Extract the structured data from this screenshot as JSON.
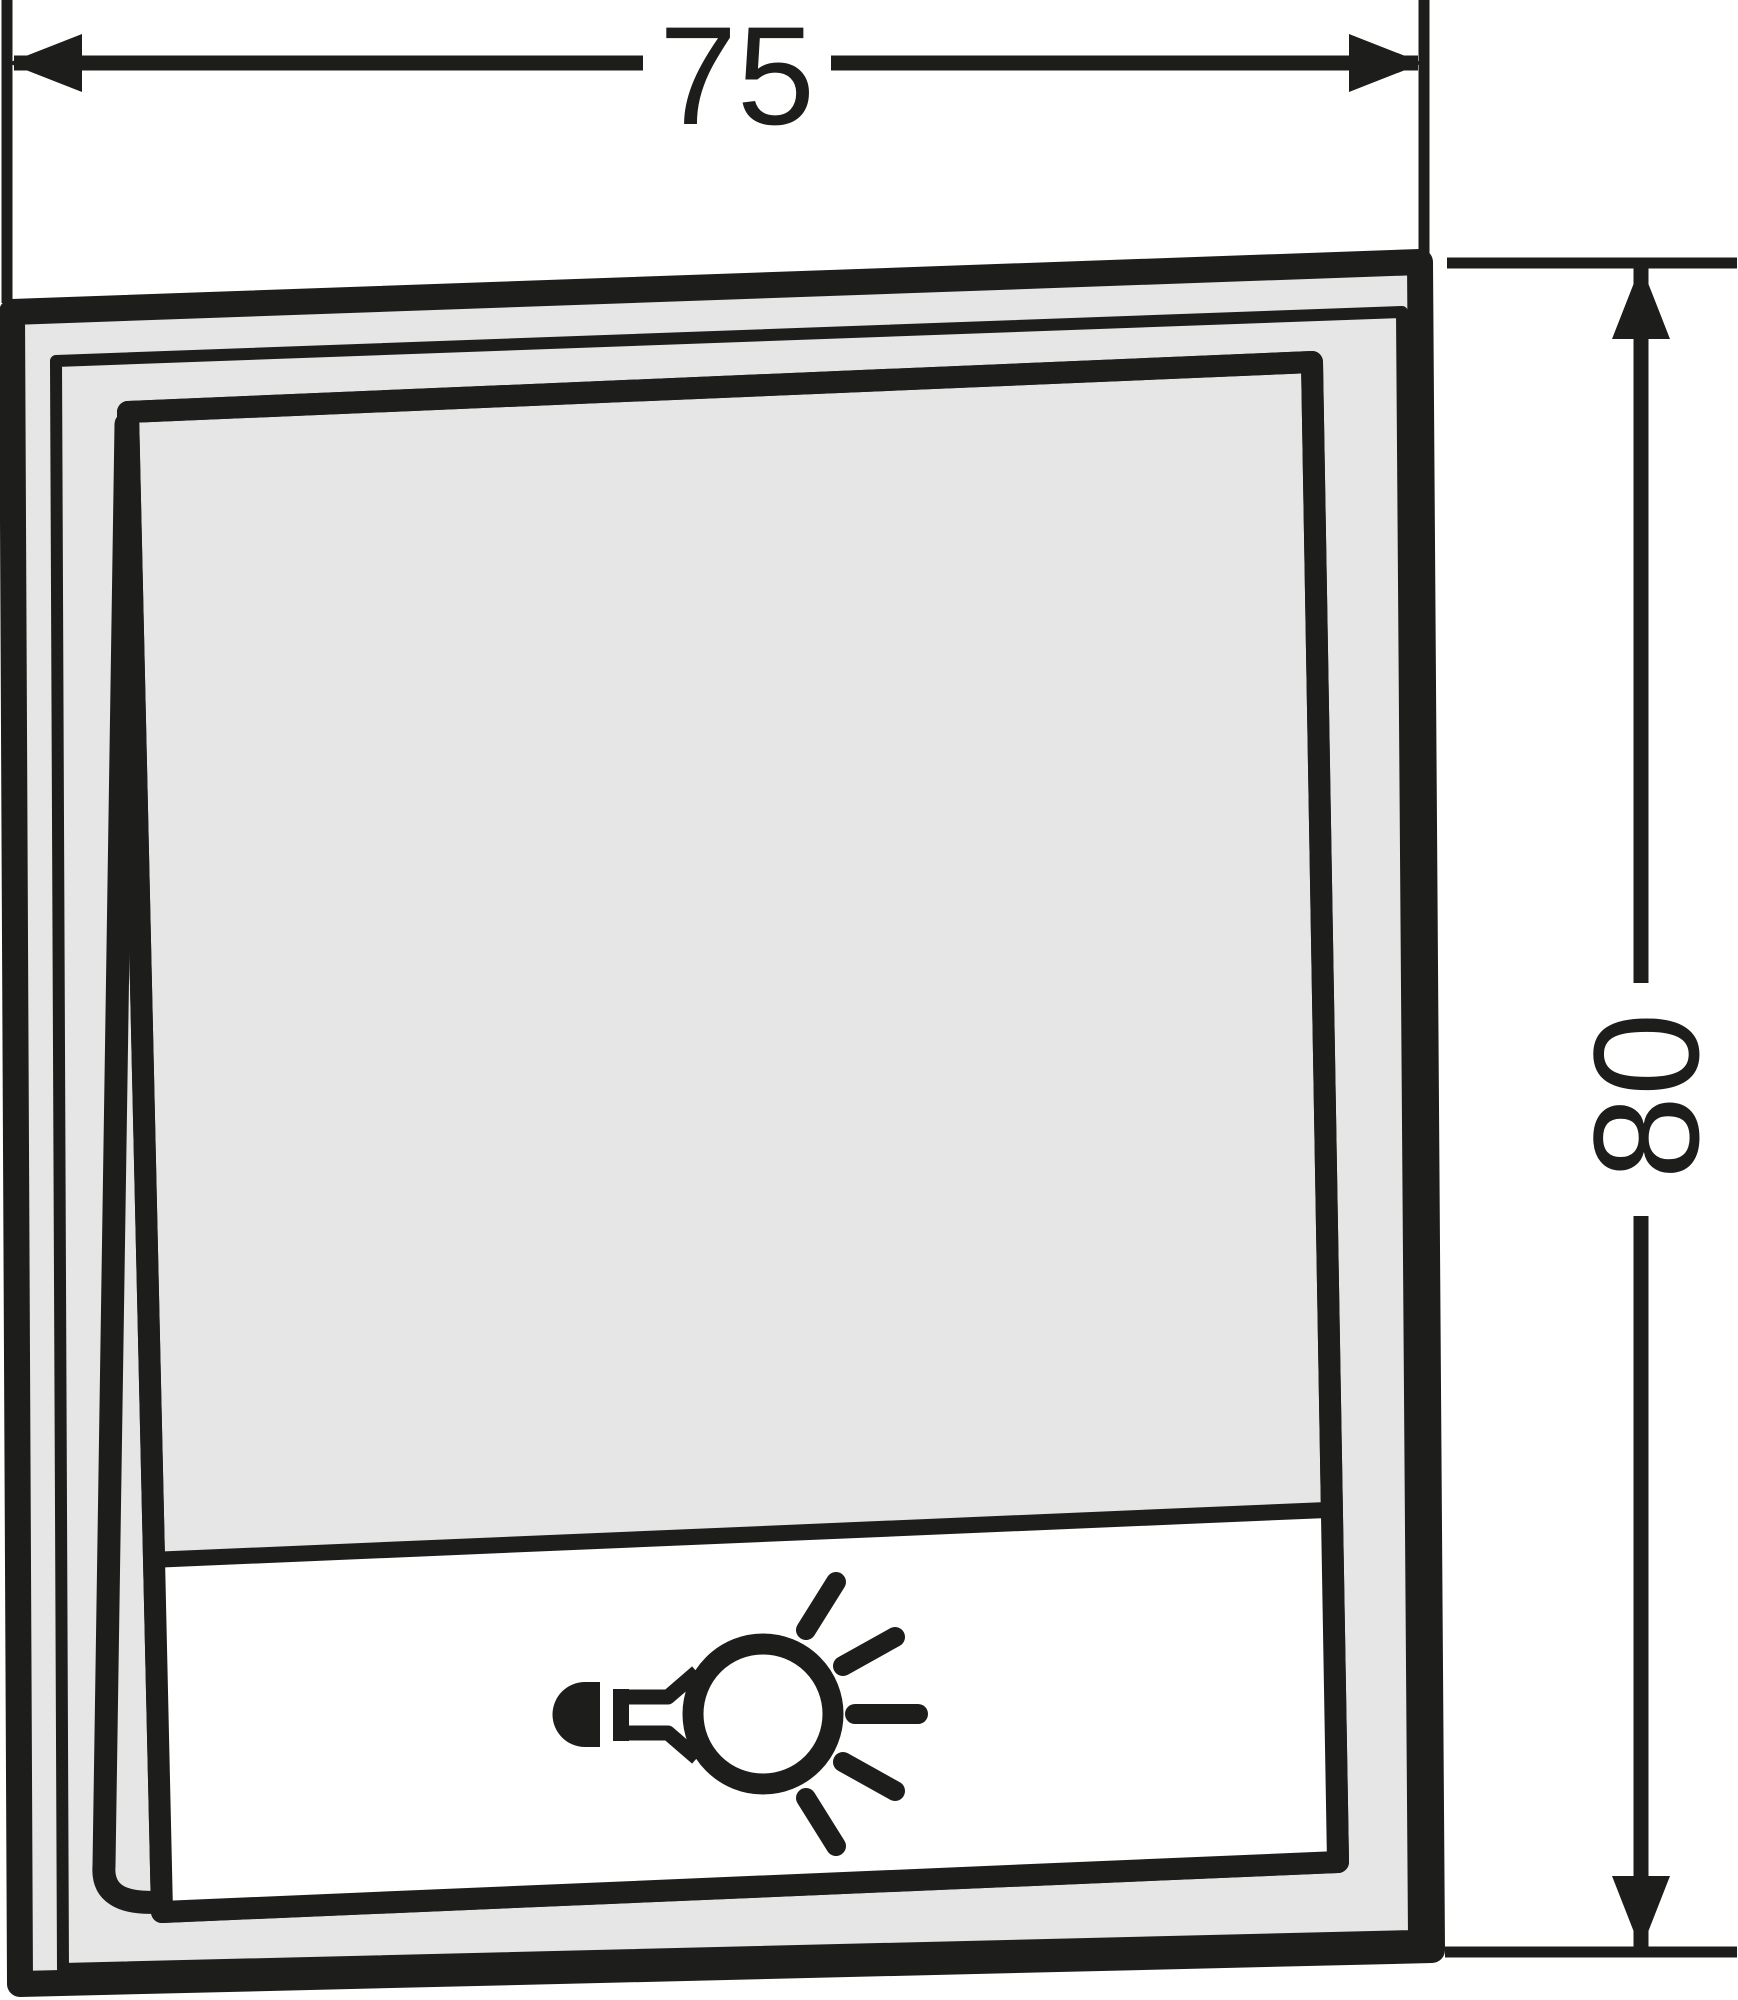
{
  "dimensions": {
    "width": {
      "value": "75"
    },
    "height": {
      "value": "80"
    }
  },
  "icon": {
    "name": "light-bulb-icon",
    "meaning": "light symbol on switch label field"
  },
  "colors": {
    "ink": "#1d1d1b",
    "panel": "#e6e6e6",
    "label_field": "#ffffff",
    "background": "#ffffff"
  }
}
